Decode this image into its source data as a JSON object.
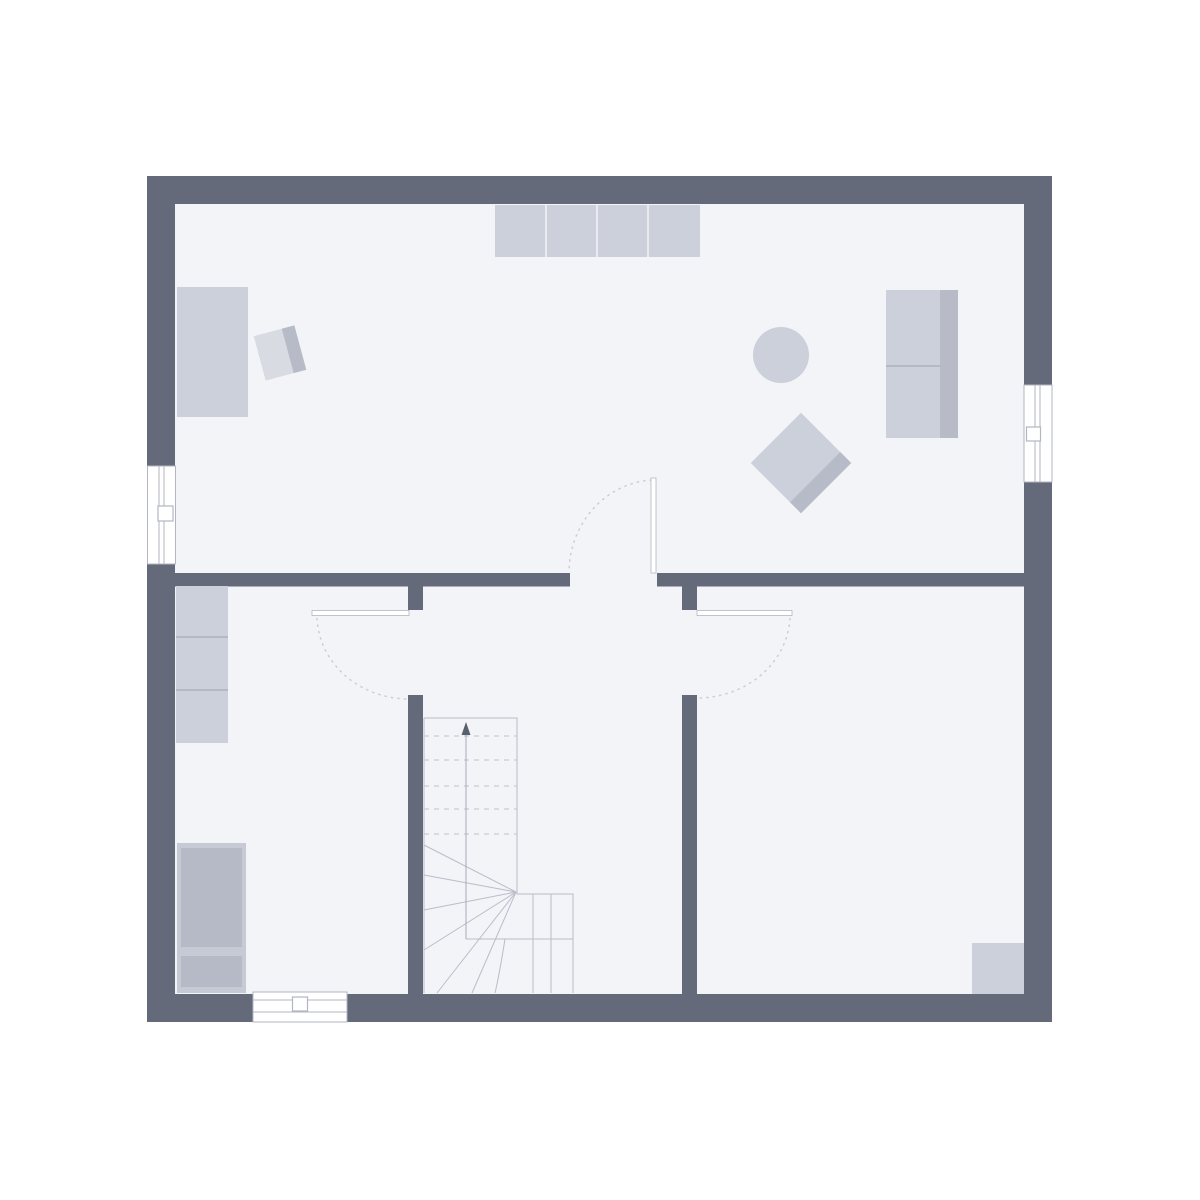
{
  "page": {
    "background": "#ffffff",
    "canvas": {
      "width": 1200,
      "height": 1200
    },
    "content_type": "architectural floor plan, no text labels"
  },
  "colors": {
    "page_bg": "#ffffff",
    "wall": "#656a7b",
    "floor": "#f3f4f8",
    "furniture": "#ccd0da",
    "furniture_dark": "#b7bbc7",
    "furniture_light": "#d8dbe2",
    "appliance_frame": "#c6cad4",
    "appliance": "#b6bac6",
    "outline": "#b9bdc9",
    "window_frame": "#b2b6c2",
    "glass": "#ffffff",
    "door_leaf": "#ffffff",
    "door_arc": "#c8ccd6",
    "tread_dash": "#ccc9d2",
    "walk_line": "#a6abb8",
    "arrow": "#596070",
    "separator": "#e9ebf1",
    "divider": "#a6abb8"
  },
  "plan": {
    "outer_wall": {
      "x": 147,
      "y": 176,
      "width": 905,
      "height": 846,
      "thickness": 28
    },
    "interior_wall_thickness": 14,
    "rooms": [
      {
        "id": "top-room",
        "bounds": {
          "x1": 175,
          "y1": 204,
          "x2": 1024,
          "y2": 573
        },
        "furniture": [
          "bed",
          "tilted-chair",
          "kitchen-counter-4-segments",
          "round-table",
          "tilted-sofa",
          "wardrobe-with-backband"
        ]
      },
      {
        "id": "bottom-left-room",
        "bounds": {
          "x1": 175,
          "y1": 586,
          "x2": 408,
          "y2": 994
        },
        "furniture": [
          "wall-cabinet-3-segments",
          "appliance-unit-two-boxes"
        ]
      },
      {
        "id": "hall-stair",
        "bounds": {
          "x1": 423,
          "y1": 586,
          "x2": 682,
          "y2": 994
        },
        "furniture": [
          "winder-staircase"
        ]
      },
      {
        "id": "bottom-right-room",
        "bounds": {
          "x1": 697,
          "y1": 586,
          "x2": 1024,
          "y2": 994
        },
        "furniture": [
          "corner-square-fixture"
        ]
      }
    ],
    "windows": [
      {
        "id": "window-left",
        "wall": "left",
        "x": 147,
        "y": 466,
        "width": 29,
        "height": 98,
        "handle_side": "room"
      },
      {
        "id": "window-right",
        "wall": "right",
        "x": 1024,
        "y": 385,
        "width": 28,
        "height": 97,
        "handle_side": "room"
      },
      {
        "id": "window-bottom",
        "wall": "bottom",
        "x": 253,
        "y": 992,
        "width": 94,
        "height": 30,
        "handle_side": "room"
      }
    ],
    "doors": [
      {
        "id": "door-top-room",
        "opening": {
          "x1": 570,
          "x2": 657,
          "at_y": 573
        },
        "leaf": "vertical at x=654, y 478-573",
        "swing": "into top room, quarter arc to left"
      },
      {
        "id": "door-bottom-left-room",
        "opening": {
          "y1": 610,
          "y2": 695,
          "at_x": 415
        },
        "leaf": "horizontal at y=613, x 312-409",
        "swing": "into bottom-left room, quarter arc downward"
      },
      {
        "id": "door-bottom-right-room",
        "opening": {
          "y1": 610,
          "y2": 695,
          "at_x": 690
        },
        "leaf": "horizontal at y=613, x 697-792",
        "swing": "into bottom-right room, quarter arc downward"
      }
    ],
    "stairs": {
      "type": "quarter-turn winder",
      "upper_flight": {
        "x1": 424,
        "y1": 718,
        "x2": 517,
        "y2": 894,
        "treads": "5 dashed lines (above section cut)"
      },
      "lower_flight": {
        "x1": 517,
        "y1": 894,
        "x2": 573,
        "y2": 993,
        "treads": "vertical dividers at x=533, x=551"
      },
      "winder_treads": 6,
      "walking_line": {
        "x": 466,
        "from_y": 939,
        "to_y": 729,
        "arrow": "up"
      }
    }
  }
}
